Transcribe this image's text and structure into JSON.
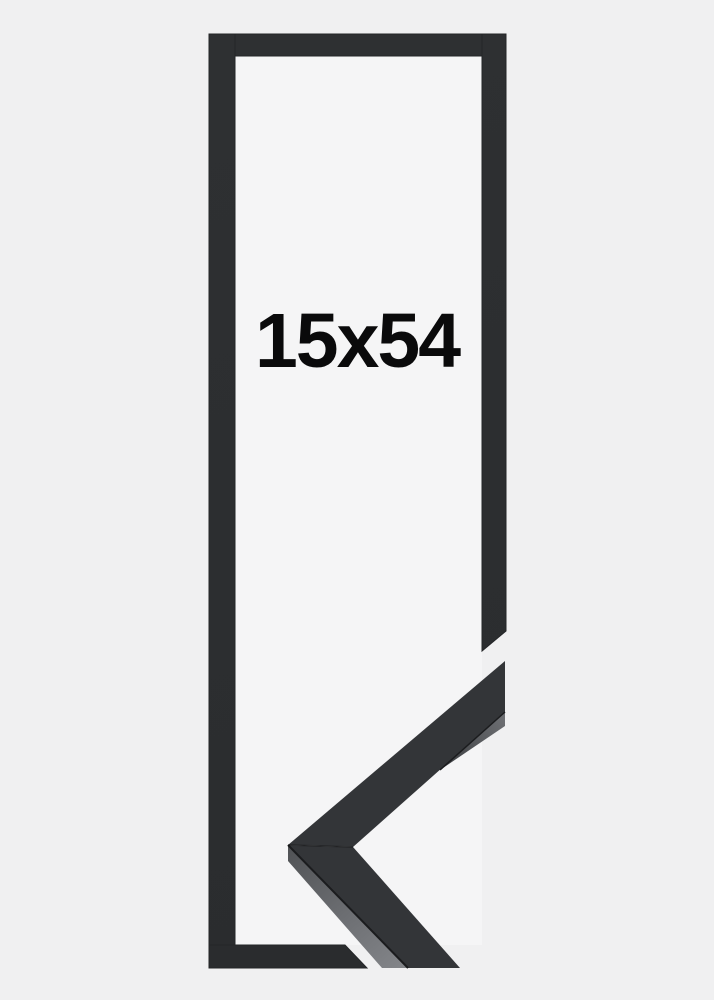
{
  "product": {
    "size_label": "15x54"
  },
  "colors": {
    "page_background": "#f0f0f1",
    "opening_background": "#f5f5f6",
    "frame_black": "#2c2e30",
    "sample_top_face": "#333538",
    "sample_edge_dark": "#1b1c1e",
    "sample_side_dark": "#55575a",
    "sample_side_light": "#84868a",
    "label_text": "#0a0a0b"
  }
}
